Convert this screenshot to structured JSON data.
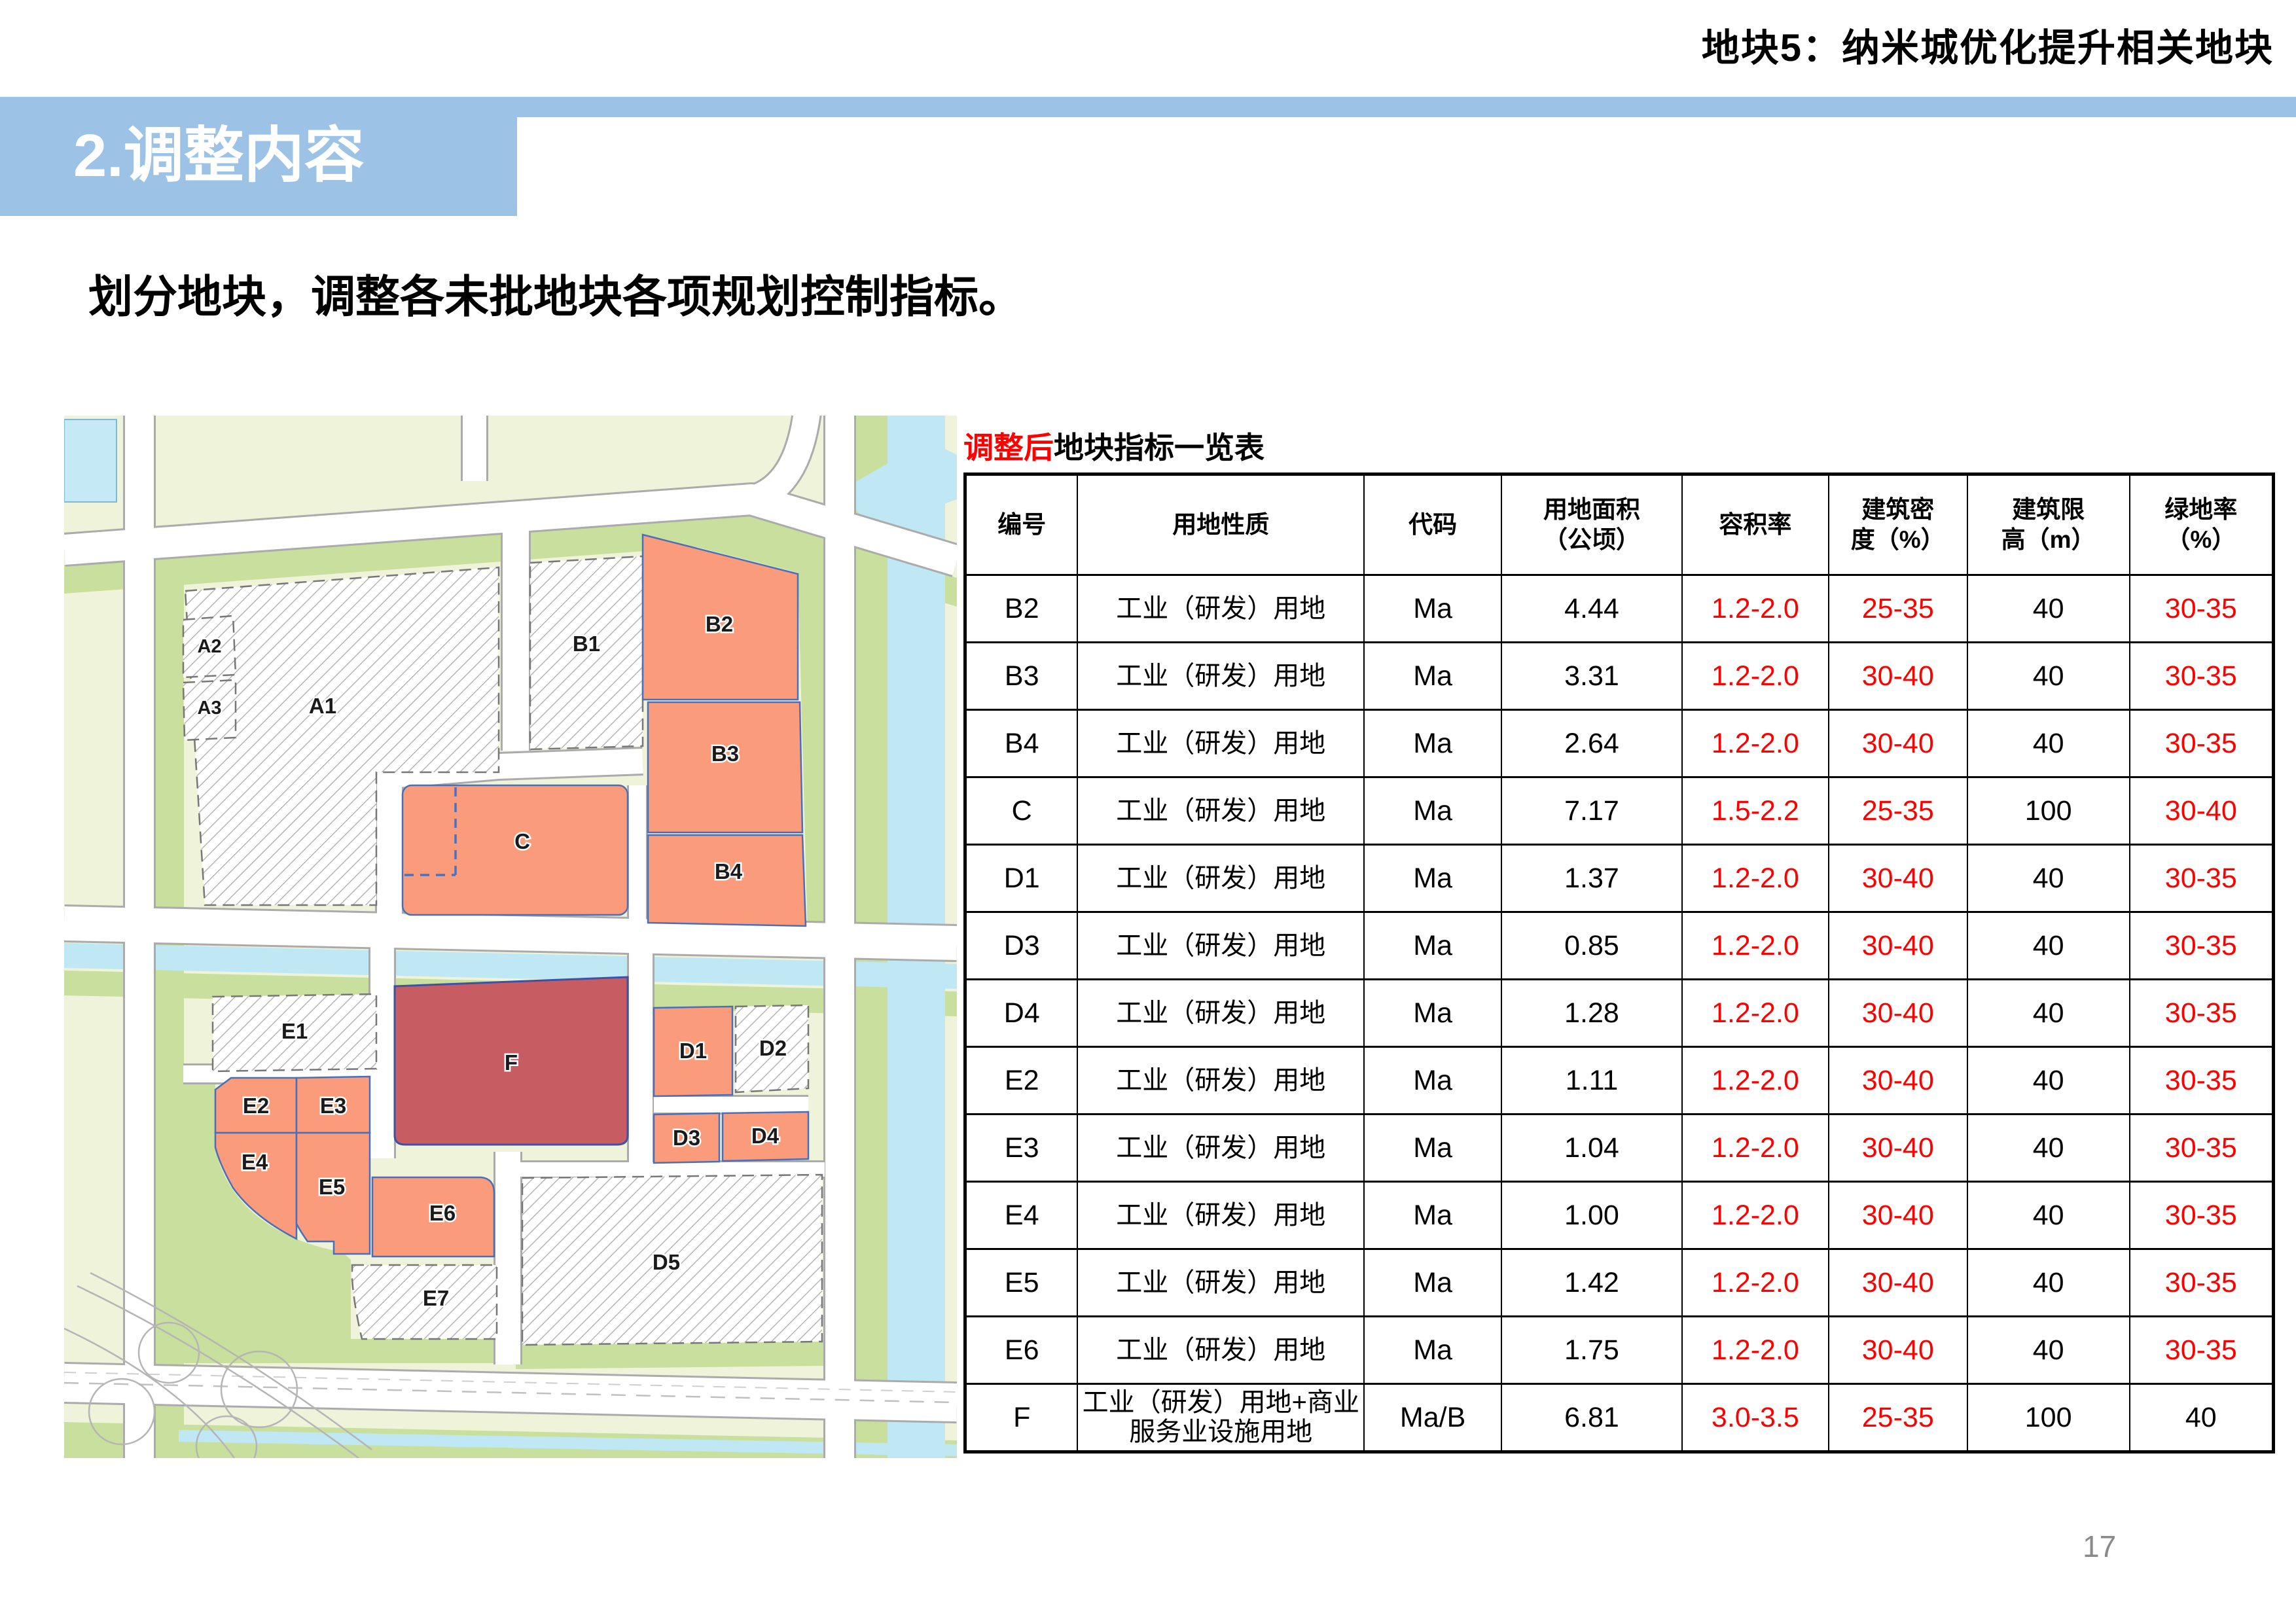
{
  "slide": {
    "title_right": "地块5：纳米城优化提升相关地块",
    "section_title": "2.调整内容",
    "body_text": "划分地块，调整各未批地块各项规划控制指标。",
    "page_number": "17"
  },
  "table": {
    "title_red": "调整后",
    "title_black": "地块指标一览表",
    "headers": [
      "编号",
      "用地性质",
      "代码",
      "用地面积\n（公顷）",
      "容积率",
      "建筑密\n度（%）",
      "建筑限\n高（m）",
      "绿地率\n（%）"
    ],
    "rows": [
      {
        "id": "B2",
        "use": "工业（研发）用地",
        "code": "Ma",
        "area": "4.44",
        "far": "1.2-2.0",
        "density": "25-35",
        "height": "40",
        "green": "30-35",
        "red": {
          "far": true,
          "density": true,
          "height": false,
          "green": true
        }
      },
      {
        "id": "B3",
        "use": "工业（研发）用地",
        "code": "Ma",
        "area": "3.31",
        "far": "1.2-2.0",
        "density": "30-40",
        "height": "40",
        "green": "30-35",
        "red": {
          "far": true,
          "density": true,
          "height": false,
          "green": true
        }
      },
      {
        "id": "B4",
        "use": "工业（研发）用地",
        "code": "Ma",
        "area": "2.64",
        "far": "1.2-2.0",
        "density": "30-40",
        "height": "40",
        "green": "30-35",
        "red": {
          "far": true,
          "density": true,
          "height": false,
          "green": true
        }
      },
      {
        "id": "C",
        "use": "工业（研发）用地",
        "code": "Ma",
        "area": "7.17",
        "far": "1.5-2.2",
        "density": "25-35",
        "height": "100",
        "green": "30-40",
        "red": {
          "far": true,
          "density": true,
          "height": false,
          "green": true
        }
      },
      {
        "id": "D1",
        "use": "工业（研发）用地",
        "code": "Ma",
        "area": "1.37",
        "far": "1.2-2.0",
        "density": "30-40",
        "height": "40",
        "green": "30-35",
        "red": {
          "far": true,
          "density": true,
          "height": false,
          "green": true
        }
      },
      {
        "id": "D3",
        "use": "工业（研发）用地",
        "code": "Ma",
        "area": "0.85",
        "far": "1.2-2.0",
        "density": "30-40",
        "height": "40",
        "green": "30-35",
        "red": {
          "far": true,
          "density": true,
          "height": false,
          "green": true
        }
      },
      {
        "id": "D4",
        "use": "工业（研发）用地",
        "code": "Ma",
        "area": "1.28",
        "far": "1.2-2.0",
        "density": "30-40",
        "height": "40",
        "green": "30-35",
        "red": {
          "far": true,
          "density": true,
          "height": false,
          "green": true
        }
      },
      {
        "id": "E2",
        "use": "工业（研发）用地",
        "code": "Ma",
        "area": "1.11",
        "far": "1.2-2.0",
        "density": "30-40",
        "height": "40",
        "green": "30-35",
        "red": {
          "far": true,
          "density": true,
          "height": false,
          "green": true
        }
      },
      {
        "id": "E3",
        "use": "工业（研发）用地",
        "code": "Ma",
        "area": "1.04",
        "far": "1.2-2.0",
        "density": "30-40",
        "height": "40",
        "green": "30-35",
        "red": {
          "far": true,
          "density": true,
          "height": false,
          "green": true
        }
      },
      {
        "id": "E4",
        "use": "工业（研发）用地",
        "code": "Ma",
        "area": "1.00",
        "far": "1.2-2.0",
        "density": "30-40",
        "height": "40",
        "green": "30-35",
        "red": {
          "far": true,
          "density": true,
          "height": false,
          "green": true
        }
      },
      {
        "id": "E5",
        "use": "工业（研发）用地",
        "code": "Ma",
        "area": "1.42",
        "far": "1.2-2.0",
        "density": "30-40",
        "height": "40",
        "green": "30-35",
        "red": {
          "far": true,
          "density": true,
          "height": false,
          "green": true
        }
      },
      {
        "id": "E6",
        "use": "工业（研发）用地",
        "code": "Ma",
        "area": "1.75",
        "far": "1.2-2.0",
        "density": "30-40",
        "height": "40",
        "green": "30-35",
        "red": {
          "far": true,
          "density": true,
          "height": false,
          "green": true
        }
      },
      {
        "id": "F",
        "use": "工业（研发）用地+商业服务业设施用地",
        "code": "Ma/B",
        "area": "6.81",
        "far": "3.0-3.5",
        "density": "25-35",
        "height": "100",
        "green": "40",
        "red": {
          "far": true,
          "density": true,
          "height": false,
          "green": false
        }
      }
    ]
  },
  "map": {
    "plots": [
      {
        "id": "A1",
        "label": "A1"
      },
      {
        "id": "A2",
        "label": "A2"
      },
      {
        "id": "A3",
        "label": "A3"
      },
      {
        "id": "B1",
        "label": "B1"
      },
      {
        "id": "B2",
        "label": "B2"
      },
      {
        "id": "B3",
        "label": "B3"
      },
      {
        "id": "B4",
        "label": "B4"
      },
      {
        "id": "C",
        "label": "C"
      },
      {
        "id": "D1",
        "label": "D1"
      },
      {
        "id": "D2",
        "label": "D2"
      },
      {
        "id": "D3",
        "label": "D3"
      },
      {
        "id": "D4",
        "label": "D4"
      },
      {
        "id": "D5",
        "label": "D5"
      },
      {
        "id": "E1",
        "label": "E1"
      },
      {
        "id": "E2",
        "label": "E2"
      },
      {
        "id": "E3",
        "label": "E3"
      },
      {
        "id": "E4",
        "label": "E4"
      },
      {
        "id": "E5",
        "label": "E5"
      },
      {
        "id": "E6",
        "label": "E6"
      },
      {
        "id": "E7",
        "label": "E7"
      },
      {
        "id": "F",
        "label": "F"
      }
    ]
  },
  "colors": {
    "accent_blue": "#9CC2E5",
    "table_red": "#FF0000",
    "plot_orange": "#FA9C7C",
    "plot_dark_red": "#C75D63",
    "map_bg": "#EEF3DA",
    "map_green": "#C8DF9D",
    "map_water": "#BFE7F4",
    "page_gray": "#8A8A8A"
  }
}
